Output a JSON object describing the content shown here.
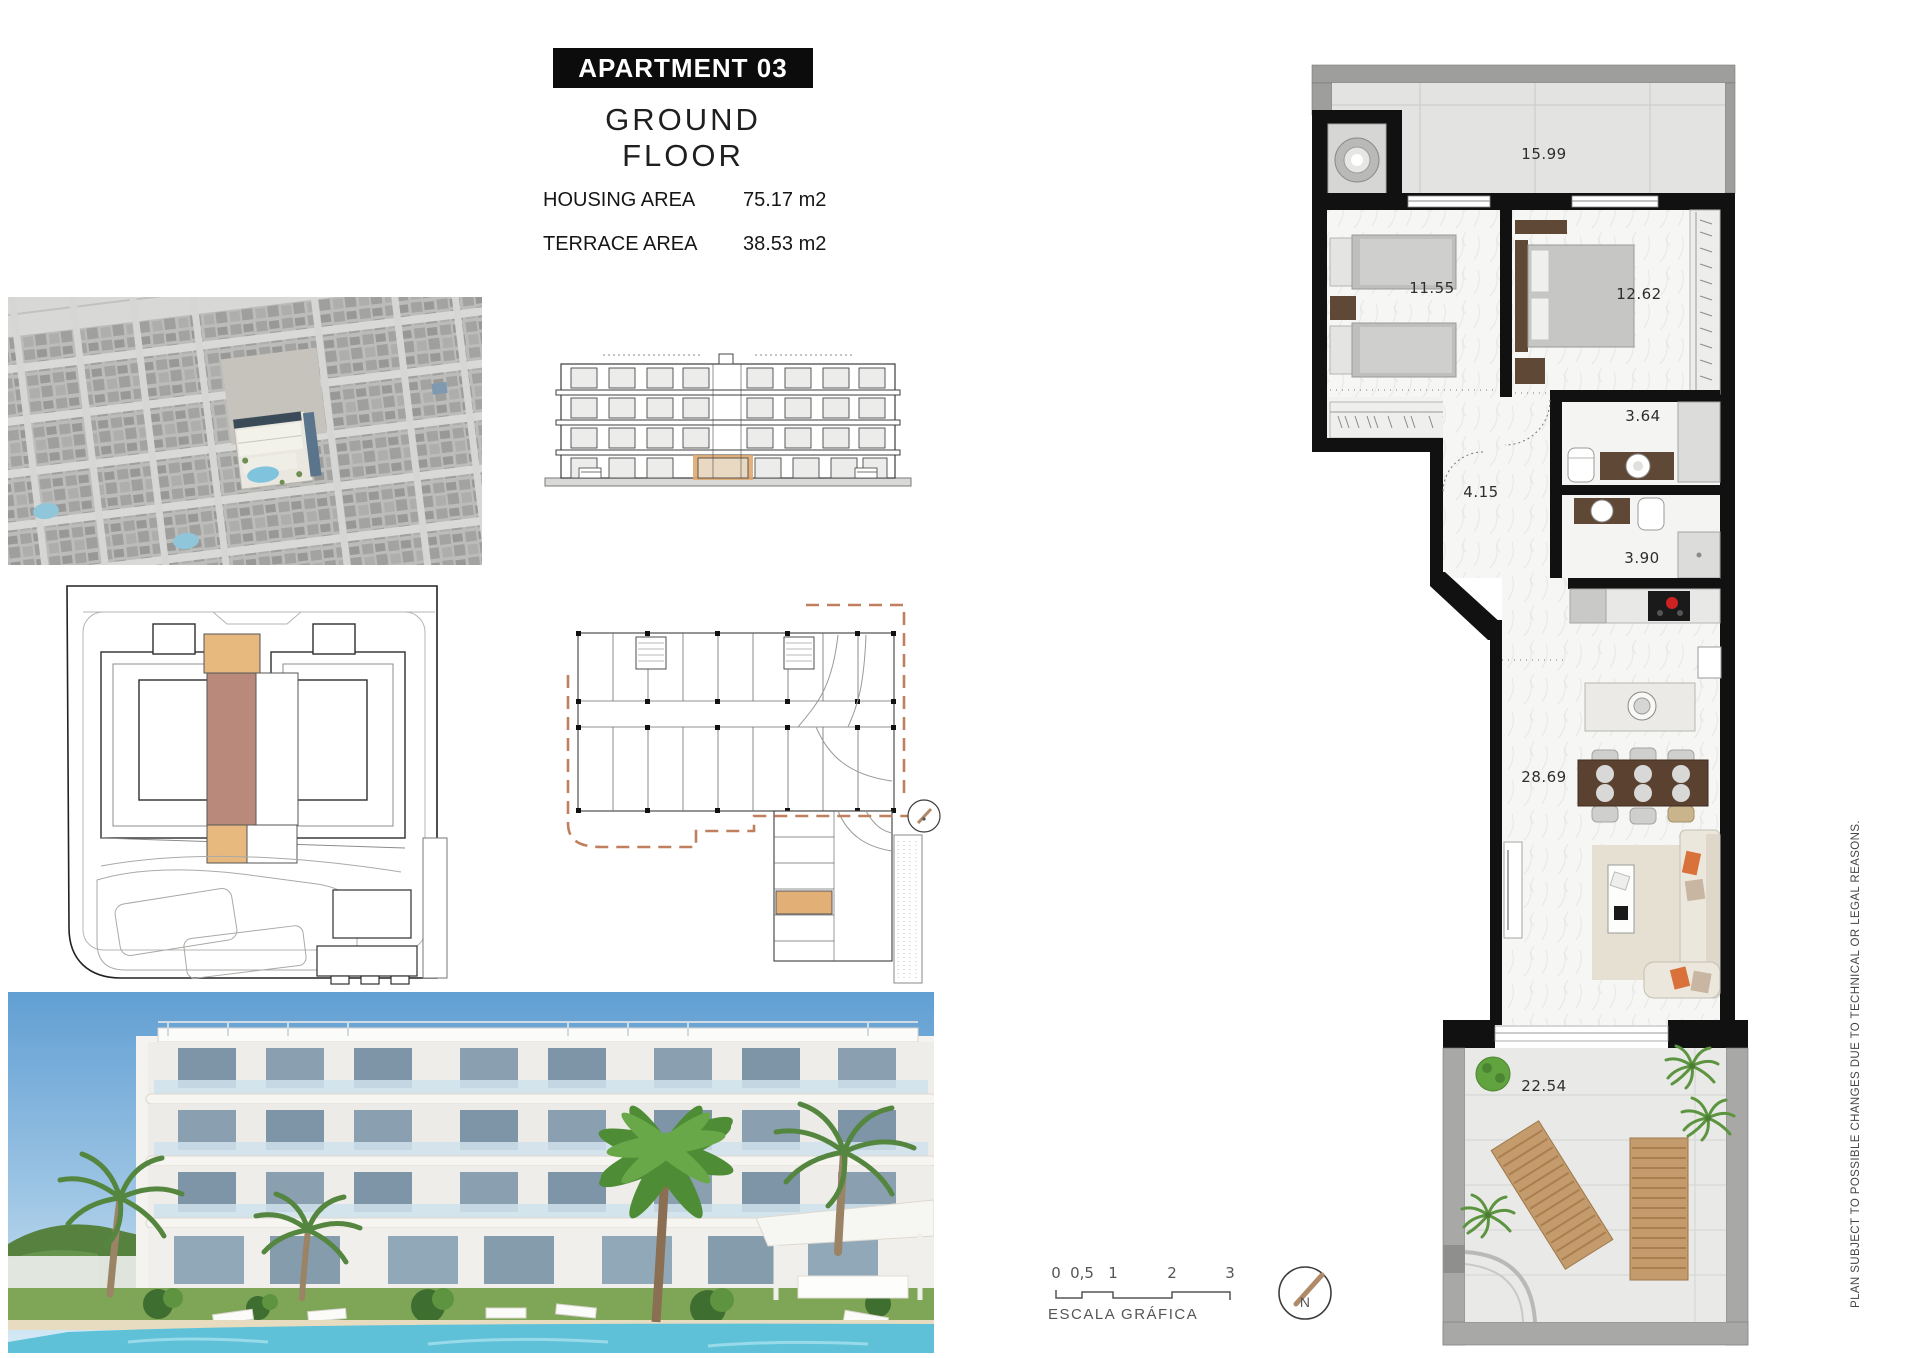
{
  "header": {
    "title": "APARTMENT 03",
    "subtitle": "GROUND FLOOR",
    "areas": [
      {
        "label": "HOUSING AREA",
        "value": "75.17 m2"
      },
      {
        "label": "TERRACE AREA",
        "value": "38.53 m2"
      }
    ]
  },
  "floor_plan": {
    "rooms": [
      {
        "id": "terrace-top",
        "area": "15.99"
      },
      {
        "id": "bedroom-twin",
        "area": "11.55"
      },
      {
        "id": "bedroom-master",
        "area": "12.62"
      },
      {
        "id": "bathroom-1",
        "area": "3.64"
      },
      {
        "id": "hall",
        "area": "4.15"
      },
      {
        "id": "bathroom-2",
        "area": "3.90"
      },
      {
        "id": "living-kitchen",
        "area": "28.69"
      },
      {
        "id": "terrace-main",
        "area": "22.54"
      }
    ]
  },
  "scale_bar": {
    "label": "ESCALA GRÁFICA",
    "ticks": [
      "0",
      "0,5",
      "1",
      "2",
      "3"
    ]
  },
  "compass": {
    "label": "N"
  },
  "legal_note": "PLAN SUBJECT TO POSSIBLE CHANGES DUE TO TECHNICAL OR LEGAL REASONS.",
  "colors": {
    "title_bg": "#0c0c0c",
    "highlight_tan": "#e8b97f",
    "highlight_mauve": "#b98a7c",
    "plan_wall": "#111111",
    "sofa_accent_orange": "#d9713a",
    "compass_needle": "#b08968",
    "pool_blue": "#6fc3d8"
  }
}
